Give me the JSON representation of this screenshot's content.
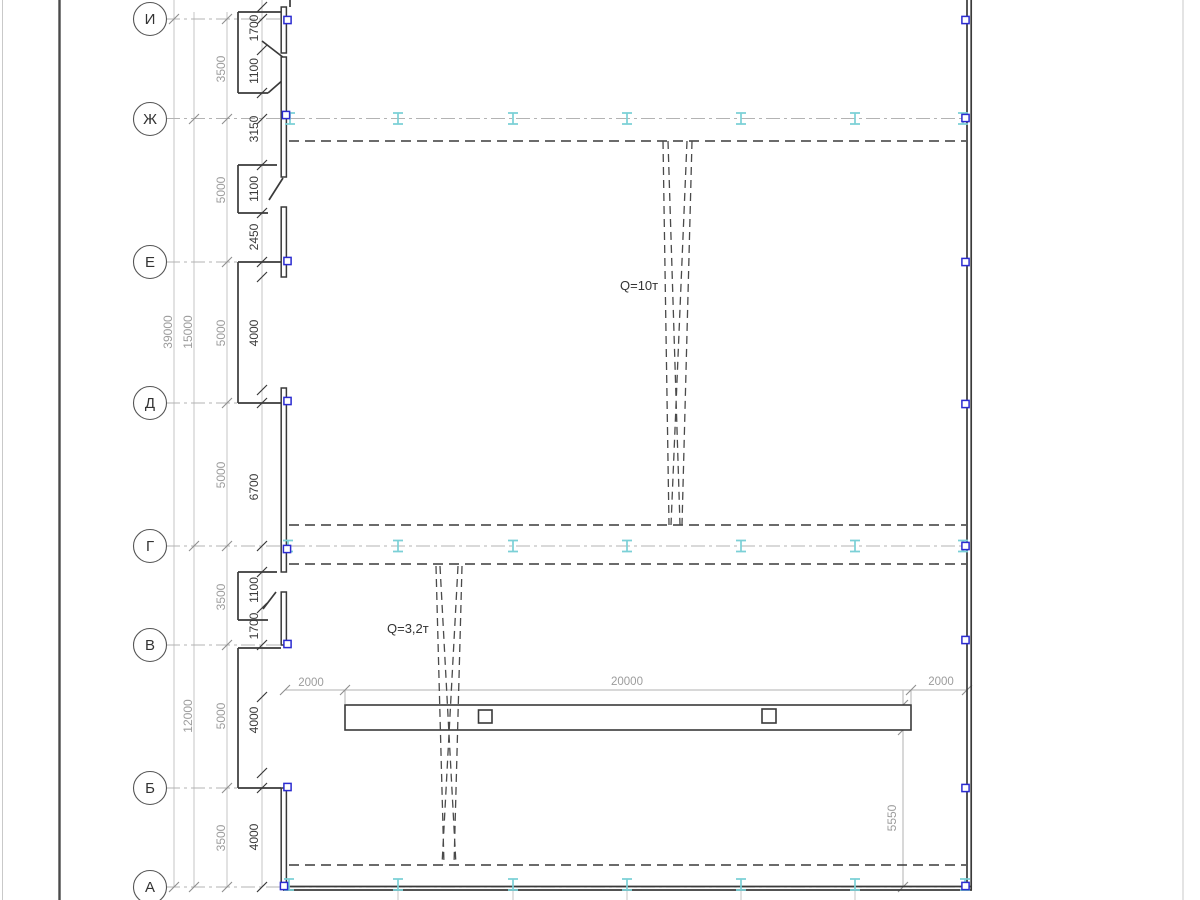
{
  "colors": {
    "crane_rail": "#7bd0d6",
    "column_marker": "#2b2bd0",
    "dim_gray": "#9c9c9c",
    "line_dark": "#3a3a3a"
  },
  "axes": {
    "labels": [
      "И",
      "Ж",
      "Е",
      "Д",
      "Г",
      "В",
      "Б",
      "А"
    ]
  },
  "dims": {
    "left_wall": [
      "1700",
      "1100",
      "3150",
      "1100",
      "2450",
      "4000",
      "6700",
      "1100",
      "1700",
      "4000",
      "4000"
    ],
    "axis_spacing": [
      "3500",
      "5000",
      "5000",
      "5000",
      "3500",
      "5000",
      "3500"
    ],
    "totals": [
      "39000",
      "15000",
      "12000"
    ],
    "top": [
      "2000",
      "20000",
      "2000"
    ],
    "beam": [
      "900",
      "5550"
    ]
  },
  "cranes": [
    {
      "capacity_label": "Q=10т"
    },
    {
      "capacity_label": "Q=3,2т"
    }
  ],
  "icons": {
    "crane_rail": "crane-rail-ibeam-icon",
    "column": "column-marker-icon"
  }
}
